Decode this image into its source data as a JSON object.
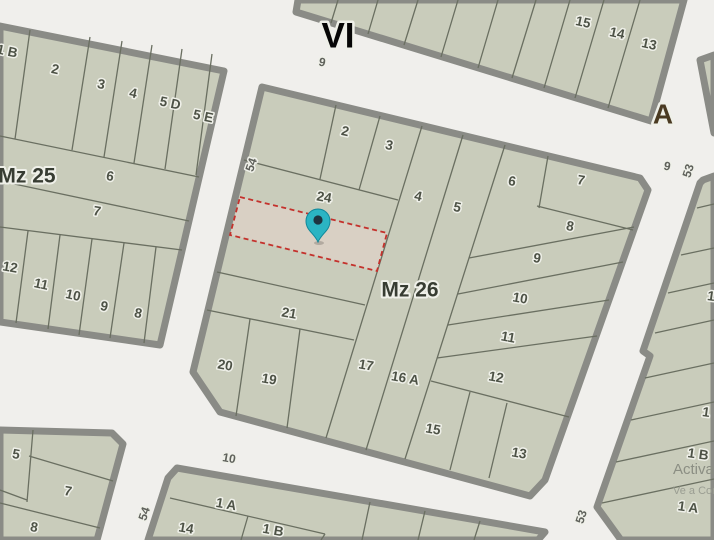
{
  "map": {
    "colors": {
      "street": "#f0efec",
      "block_fill": "#c9ccbb",
      "casing": "#8a8b86",
      "parcel_line": "#6a6f61",
      "selected_fill": "#d9d0c4",
      "selected_border": "#c4312c",
      "pin": "#2bb4c3",
      "pin_dot": "#1e3441"
    },
    "region_labels": [
      {
        "text": "VI",
        "x": 338,
        "y": 38,
        "rot": 0,
        "cls": "t-vi",
        "name": "street-name-vi"
      },
      {
        "text": "A",
        "x": 663,
        "y": 116,
        "rot": 0,
        "cls": "t-a",
        "name": "street-name-a"
      },
      {
        "text": "Mz 25",
        "x": 27,
        "y": 177,
        "rot": 0,
        "cls": "t-mz",
        "name": "block-label-mz25"
      },
      {
        "text": "Mz 26",
        "x": 410,
        "y": 291,
        "rot": 0,
        "cls": "t-mz",
        "name": "block-label-mz26"
      }
    ],
    "street_labels": [
      {
        "text": "9",
        "x": 322,
        "y": 63,
        "rot": 12
      },
      {
        "text": "54",
        "x": 252,
        "y": 165,
        "rot": -71
      },
      {
        "text": "9",
        "x": 667,
        "y": 167,
        "rot": 12
      },
      {
        "text": "53",
        "x": 689,
        "y": 171,
        "rot": -72
      },
      {
        "text": "10",
        "x": 229,
        "y": 459,
        "rot": 10
      },
      {
        "text": "54",
        "x": 145,
        "y": 514,
        "rot": -71
      },
      {
        "text": "53",
        "x": 582,
        "y": 517,
        "rot": -72
      }
    ],
    "parcel_labels": [
      {
        "text": "1 B",
        "x": 7,
        "y": 52,
        "rot": 12
      },
      {
        "text": "2",
        "x": 55,
        "y": 70,
        "rot": 12
      },
      {
        "text": "3",
        "x": 101,
        "y": 85,
        "rot": 12
      },
      {
        "text": "4",
        "x": 133,
        "y": 94,
        "rot": 12
      },
      {
        "text": "5 D",
        "x": 170,
        "y": 104,
        "rot": 12
      },
      {
        "text": "5 E",
        "x": 203,
        "y": 117,
        "rot": 12
      },
      {
        "text": "6",
        "x": 110,
        "y": 177,
        "rot": 10
      },
      {
        "text": "7",
        "x": 97,
        "y": 212,
        "rot": 10
      },
      {
        "text": "12",
        "x": 10,
        "y": 268,
        "rot": 10
      },
      {
        "text": "11",
        "x": 41,
        "y": 285,
        "rot": 12
      },
      {
        "text": "10",
        "x": 73,
        "y": 296,
        "rot": 12
      },
      {
        "text": "9",
        "x": 104,
        "y": 307,
        "rot": 12
      },
      {
        "text": "8",
        "x": 138,
        "y": 314,
        "rot": 12
      },
      {
        "text": "15",
        "x": 583,
        "y": 23,
        "rot": 12
      },
      {
        "text": "14",
        "x": 617,
        "y": 34,
        "rot": 12
      },
      {
        "text": "13",
        "x": 649,
        "y": 45,
        "rot": 12
      },
      {
        "text": "2",
        "x": 345,
        "y": 132,
        "rot": 12
      },
      {
        "text": "3",
        "x": 389,
        "y": 146,
        "rot": 12
      },
      {
        "text": "24",
        "x": 324,
        "y": 198,
        "rot": 10
      },
      {
        "text": "4",
        "x": 418,
        "y": 197,
        "rot": 12
      },
      {
        "text": "5",
        "x": 457,
        "y": 208,
        "rot": 12
      },
      {
        "text": "6",
        "x": 512,
        "y": 182,
        "rot": 10
      },
      {
        "text": "7",
        "x": 581,
        "y": 181,
        "rot": 10
      },
      {
        "text": "8",
        "x": 570,
        "y": 227,
        "rot": 10
      },
      {
        "text": "9",
        "x": 537,
        "y": 259,
        "rot": 10
      },
      {
        "text": "10",
        "x": 520,
        "y": 299,
        "rot": 10
      },
      {
        "text": "11",
        "x": 508,
        "y": 338,
        "rot": 10
      },
      {
        "text": "12",
        "x": 496,
        "y": 378,
        "rot": 10
      },
      {
        "text": "21",
        "x": 289,
        "y": 314,
        "rot": 10
      },
      {
        "text": "20",
        "x": 225,
        "y": 366,
        "rot": 10
      },
      {
        "text": "19",
        "x": 269,
        "y": 380,
        "rot": 10
      },
      {
        "text": "17",
        "x": 366,
        "y": 366,
        "rot": 10
      },
      {
        "text": "16 A",
        "x": 405,
        "y": 379,
        "rot": 10
      },
      {
        "text": "15",
        "x": 433,
        "y": 430,
        "rot": 10
      },
      {
        "text": "13",
        "x": 519,
        "y": 454,
        "rot": 10
      },
      {
        "text": "5",
        "x": 16,
        "y": 455,
        "rot": 10
      },
      {
        "text": "7",
        "x": 68,
        "y": 492,
        "rot": 10
      },
      {
        "text": "8",
        "x": 34,
        "y": 528,
        "rot": 10
      },
      {
        "text": "1 A",
        "x": 226,
        "y": 505,
        "rot": 10
      },
      {
        "text": "14",
        "x": 186,
        "y": 529,
        "rot": 10
      },
      {
        "text": "1 B",
        "x": 273,
        "y": 531,
        "rot": 10
      },
      {
        "text": "1",
        "x": 711,
        "y": 297,
        "rot": 8
      },
      {
        "text": "1",
        "x": 706,
        "y": 413,
        "rot": 8
      },
      {
        "text": "1 B",
        "x": 698,
        "y": 455,
        "rot": 8
      },
      {
        "text": "1 A",
        "x": 688,
        "y": 508,
        "rot": 8
      }
    ],
    "selected_parcel": {
      "label": "24"
    },
    "watermark": {
      "line1": "Activar Windows",
      "line2": "Ve a Configuración para activar Windows."
    }
  }
}
